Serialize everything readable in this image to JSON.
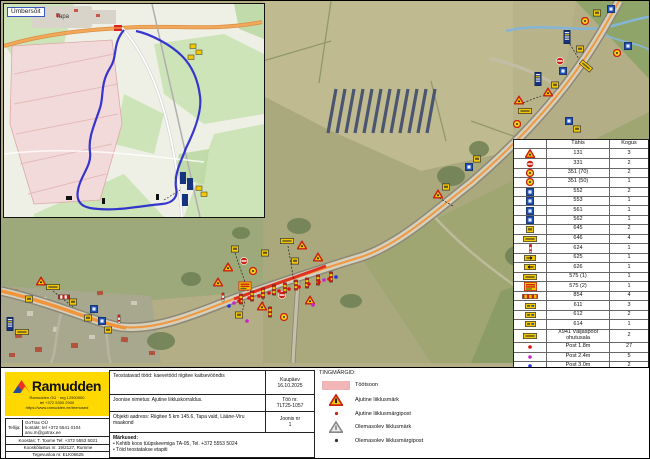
{
  "inset": {
    "label": "Ümbersõit",
    "town": "Tapa"
  },
  "sign_table": {
    "headers": {
      "symbol": "",
      "code": "Tähis",
      "qty": "Kogus"
    },
    "rows": [
      {
        "icon": "warn",
        "code": "131",
        "qty": "3"
      },
      {
        "icon": "noentry",
        "code": "331",
        "qty": "2"
      },
      {
        "icon": "speed",
        "code": "351 (70)",
        "qty": "2"
      },
      {
        "icon": "speed",
        "code": "351 (50)",
        "qty": "1"
      },
      {
        "icon": "blue",
        "code": "552",
        "qty": "2"
      },
      {
        "icon": "blue",
        "code": "553",
        "qty": "1"
      },
      {
        "icon": "blue",
        "code": "561",
        "qty": "1"
      },
      {
        "icon": "blue",
        "code": "562",
        "qty": "1"
      },
      {
        "icon": "yb",
        "code": "645",
        "qty": "2"
      },
      {
        "icon": "ybw",
        "code": "646",
        "qty": "4"
      },
      {
        "icon": "post",
        "code": "624",
        "qty": "1"
      },
      {
        "icon": "arrowR",
        "code": "625",
        "qty": "1"
      },
      {
        "icon": "arrowL",
        "code": "626",
        "qty": "1"
      },
      {
        "icon": "ybw",
        "code": "575 (1)",
        "qty": "1"
      },
      {
        "icon": "ybr",
        "code": "575 (2)",
        "qty": "1"
      },
      {
        "icon": "striped854",
        "code": "854",
        "qty": "4"
      },
      {
        "icon": "yb611",
        "code": "611",
        "qty": "3"
      },
      {
        "icon": "yb611",
        "code": "612",
        "qty": "2"
      },
      {
        "icon": "yb611",
        "code": "614",
        "qty": "1"
      },
      {
        "icon": "ybw",
        "code": "X941 Väljaspool ohutusala",
        "qty": "2"
      },
      {
        "icon": "dotR",
        "code": "Post 1.8m",
        "qty": "27"
      },
      {
        "icon": "dotM",
        "code": "Post 2.4m",
        "qty": "5"
      },
      {
        "icon": "dotB",
        "code": "Post 3.0m",
        "qty": "2"
      },
      {
        "icon": "lamp",
        "code": "Punane lamp",
        "qty": "4"
      }
    ]
  },
  "symbols": {
    "title": "TINGMÄRGID:",
    "items": [
      {
        "icon": "pinkrect",
        "label": "Töötsoon"
      },
      {
        "icon": "warnbig",
        "label": "Ajutine liiklusmärk"
      },
      {
        "icon": "dotRs",
        "label": "Ajutine liiklusmärgipost"
      },
      {
        "icon": "gtri",
        "label": "Olemasolev liiklusmärk"
      },
      {
        "icon": "dotKs",
        "label": "Olemasolev liiklusmärgipost"
      }
    ]
  },
  "info": {
    "description": "Teostatavad tööd: kaevetööd riigitee kaitsevööndis",
    "date_label": "Kuupäev",
    "date": "16.10.2025",
    "drawing_name": "Joonise nimetus: Ajutine liikluskorraldus.",
    "work_no_label": "Töö nr.",
    "work_no": "TLT25-1057",
    "address": "Objekti aadress: Riigitee 5 km 145.6, Tapa vald, Lääne-Viru maakond",
    "drawing_no_label": "Joonis nr",
    "drawing_no": "1",
    "notes_label": "Märkused:",
    "notes": [
      "Kehtib koos tüüpskeemiga TA-05, Tel. +372 5553 5024",
      "Töid teostatakse etapiti"
    ]
  },
  "contact": {
    "client_label": "Tellija:",
    "client_lines": [
      "GoTrax OÜ",
      "kontakt: tel +372 5541 0104",
      "anu.m@gotrax.ee"
    ],
    "author": "Koostas: T. Toome Tel: +372 5553 5021",
    "approval": "Kooskõlastus nr. 19/2127, Rumme",
    "permit": "Tegevusloa nr. ELK06625"
  },
  "logo": {
    "company": "Ramudden",
    "sub_lines": [
      "Ramudden OÜ · reg 12900900",
      "tel +372 5300 2900",
      "https://www.ramudden.ee/teenused"
    ]
  },
  "colors": {
    "accent_yellow": "#ffd800",
    "sign_red": "#cc2211",
    "route_blue": "#2222cc",
    "work_zone_red": "#e03020",
    "work_zone_pink": "#f3b6b6"
  },
  "map": {
    "signs": [
      {
        "t": "speed",
        "x": 584,
        "y": 20
      },
      {
        "t": "yb",
        "x": 596,
        "y": 12
      },
      {
        "t": "blue",
        "x": 610,
        "y": 8
      },
      {
        "t": "bluetall",
        "x": 566,
        "y": 36
      },
      {
        "t": "yb",
        "x": 579,
        "y": 48
      },
      {
        "t": "noentry",
        "x": 559,
        "y": 60
      },
      {
        "t": "speed",
        "x": 616,
        "y": 52
      },
      {
        "t": "blue",
        "x": 627,
        "y": 45
      },
      {
        "t": "bluetall",
        "x": 537,
        "y": 78
      },
      {
        "t": "warn",
        "x": 547,
        "y": 91
      },
      {
        "t": "yb",
        "x": 554,
        "y": 84
      },
      {
        "t": "blue",
        "x": 562,
        "y": 70
      },
      {
        "t": "warn",
        "x": 518,
        "y": 99
      },
      {
        "t": "ybw",
        "x": 524,
        "y": 110
      },
      {
        "t": "speed",
        "x": 516,
        "y": 123
      },
      {
        "t": "ybw",
        "x": 585,
        "y": 65,
        "r": 40
      },
      {
        "t": "blue",
        "x": 568,
        "y": 120
      },
      {
        "t": "yb",
        "x": 576,
        "y": 128
      },
      {
        "t": "blue",
        "x": 468,
        "y": 166
      },
      {
        "t": "yb",
        "x": 476,
        "y": 158
      },
      {
        "t": "warn",
        "x": 437,
        "y": 193
      },
      {
        "t": "yb",
        "x": 445,
        "y": 186
      },
      {
        "t": "yb",
        "x": 234,
        "y": 248
      },
      {
        "t": "noentry",
        "x": 243,
        "y": 260
      },
      {
        "t": "warn",
        "x": 227,
        "y": 266
      },
      {
        "t": "yb",
        "x": 264,
        "y": 252
      },
      {
        "t": "ybw",
        "x": 286,
        "y": 240
      },
      {
        "t": "warn",
        "x": 301,
        "y": 244
      },
      {
        "t": "speed",
        "x": 252,
        "y": 270
      },
      {
        "t": "ybr",
        "x": 244,
        "y": 285
      },
      {
        "t": "yb",
        "x": 294,
        "y": 260
      },
      {
        "t": "warn",
        "x": 317,
        "y": 256
      },
      {
        "t": "noentry",
        "x": 281,
        "y": 294
      },
      {
        "t": "warn",
        "x": 261,
        "y": 305
      },
      {
        "t": "yb",
        "x": 238,
        "y": 314
      },
      {
        "t": "speed",
        "x": 283,
        "y": 316
      },
      {
        "t": "warn",
        "x": 309,
        "y": 299
      },
      {
        "t": "warn",
        "x": 217,
        "y": 281
      },
      {
        "t": "striped",
        "x": 240,
        "y": 298
      },
      {
        "t": "striped",
        "x": 251,
        "y": 295
      },
      {
        "t": "striped",
        "x": 262,
        "y": 292
      },
      {
        "t": "striped",
        "x": 273,
        "y": 289
      },
      {
        "t": "striped",
        "x": 284,
        "y": 287
      },
      {
        "t": "striped",
        "x": 295,
        "y": 284
      },
      {
        "t": "striped",
        "x": 306,
        "y": 282
      },
      {
        "t": "striped",
        "x": 317,
        "y": 279
      },
      {
        "t": "striped",
        "x": 269,
        "y": 311
      },
      {
        "t": "striped",
        "x": 330,
        "y": 276
      },
      {
        "t": "dotR",
        "x": 238,
        "y": 300
      },
      {
        "t": "dotR",
        "x": 248,
        "y": 297
      },
      {
        "t": "dotR",
        "x": 258,
        "y": 295
      },
      {
        "t": "dotR",
        "x": 268,
        "y": 292
      },
      {
        "t": "dotR",
        "x": 278,
        "y": 290
      },
      {
        "t": "dotR",
        "x": 288,
        "y": 288
      },
      {
        "t": "dotR",
        "x": 298,
        "y": 286
      },
      {
        "t": "dotR",
        "x": 308,
        "y": 283
      },
      {
        "t": "dotR",
        "x": 318,
        "y": 281
      },
      {
        "t": "dotR",
        "x": 328,
        "y": 278
      },
      {
        "t": "dotM",
        "x": 233,
        "y": 302
      },
      {
        "t": "dotM",
        "x": 323,
        "y": 279
      },
      {
        "t": "dotM",
        "x": 246,
        "y": 320
      },
      {
        "t": "dotM",
        "x": 312,
        "y": 304
      },
      {
        "t": "dotB",
        "x": 228,
        "y": 305
      },
      {
        "t": "dotB",
        "x": 335,
        "y": 276
      },
      {
        "t": "ybw",
        "x": 52,
        "y": 286
      },
      {
        "t": "stripedH",
        "x": 63,
        "y": 296
      },
      {
        "t": "yb",
        "x": 72,
        "y": 301
      },
      {
        "t": "blue",
        "x": 93,
        "y": 308
      },
      {
        "t": "yb",
        "x": 87,
        "y": 317
      },
      {
        "t": "blue",
        "x": 101,
        "y": 320
      },
      {
        "t": "yb",
        "x": 107,
        "y": 329
      },
      {
        "t": "warn",
        "x": 40,
        "y": 280
      },
      {
        "t": "yb",
        "x": 28,
        "y": 298
      },
      {
        "t": "bluetall",
        "x": 9,
        "y": 323
      },
      {
        "t": "ybw",
        "x": 21,
        "y": 331
      },
      {
        "t": "post",
        "x": 118,
        "y": 318
      },
      {
        "t": "post",
        "x": 222,
        "y": 296
      }
    ]
  }
}
